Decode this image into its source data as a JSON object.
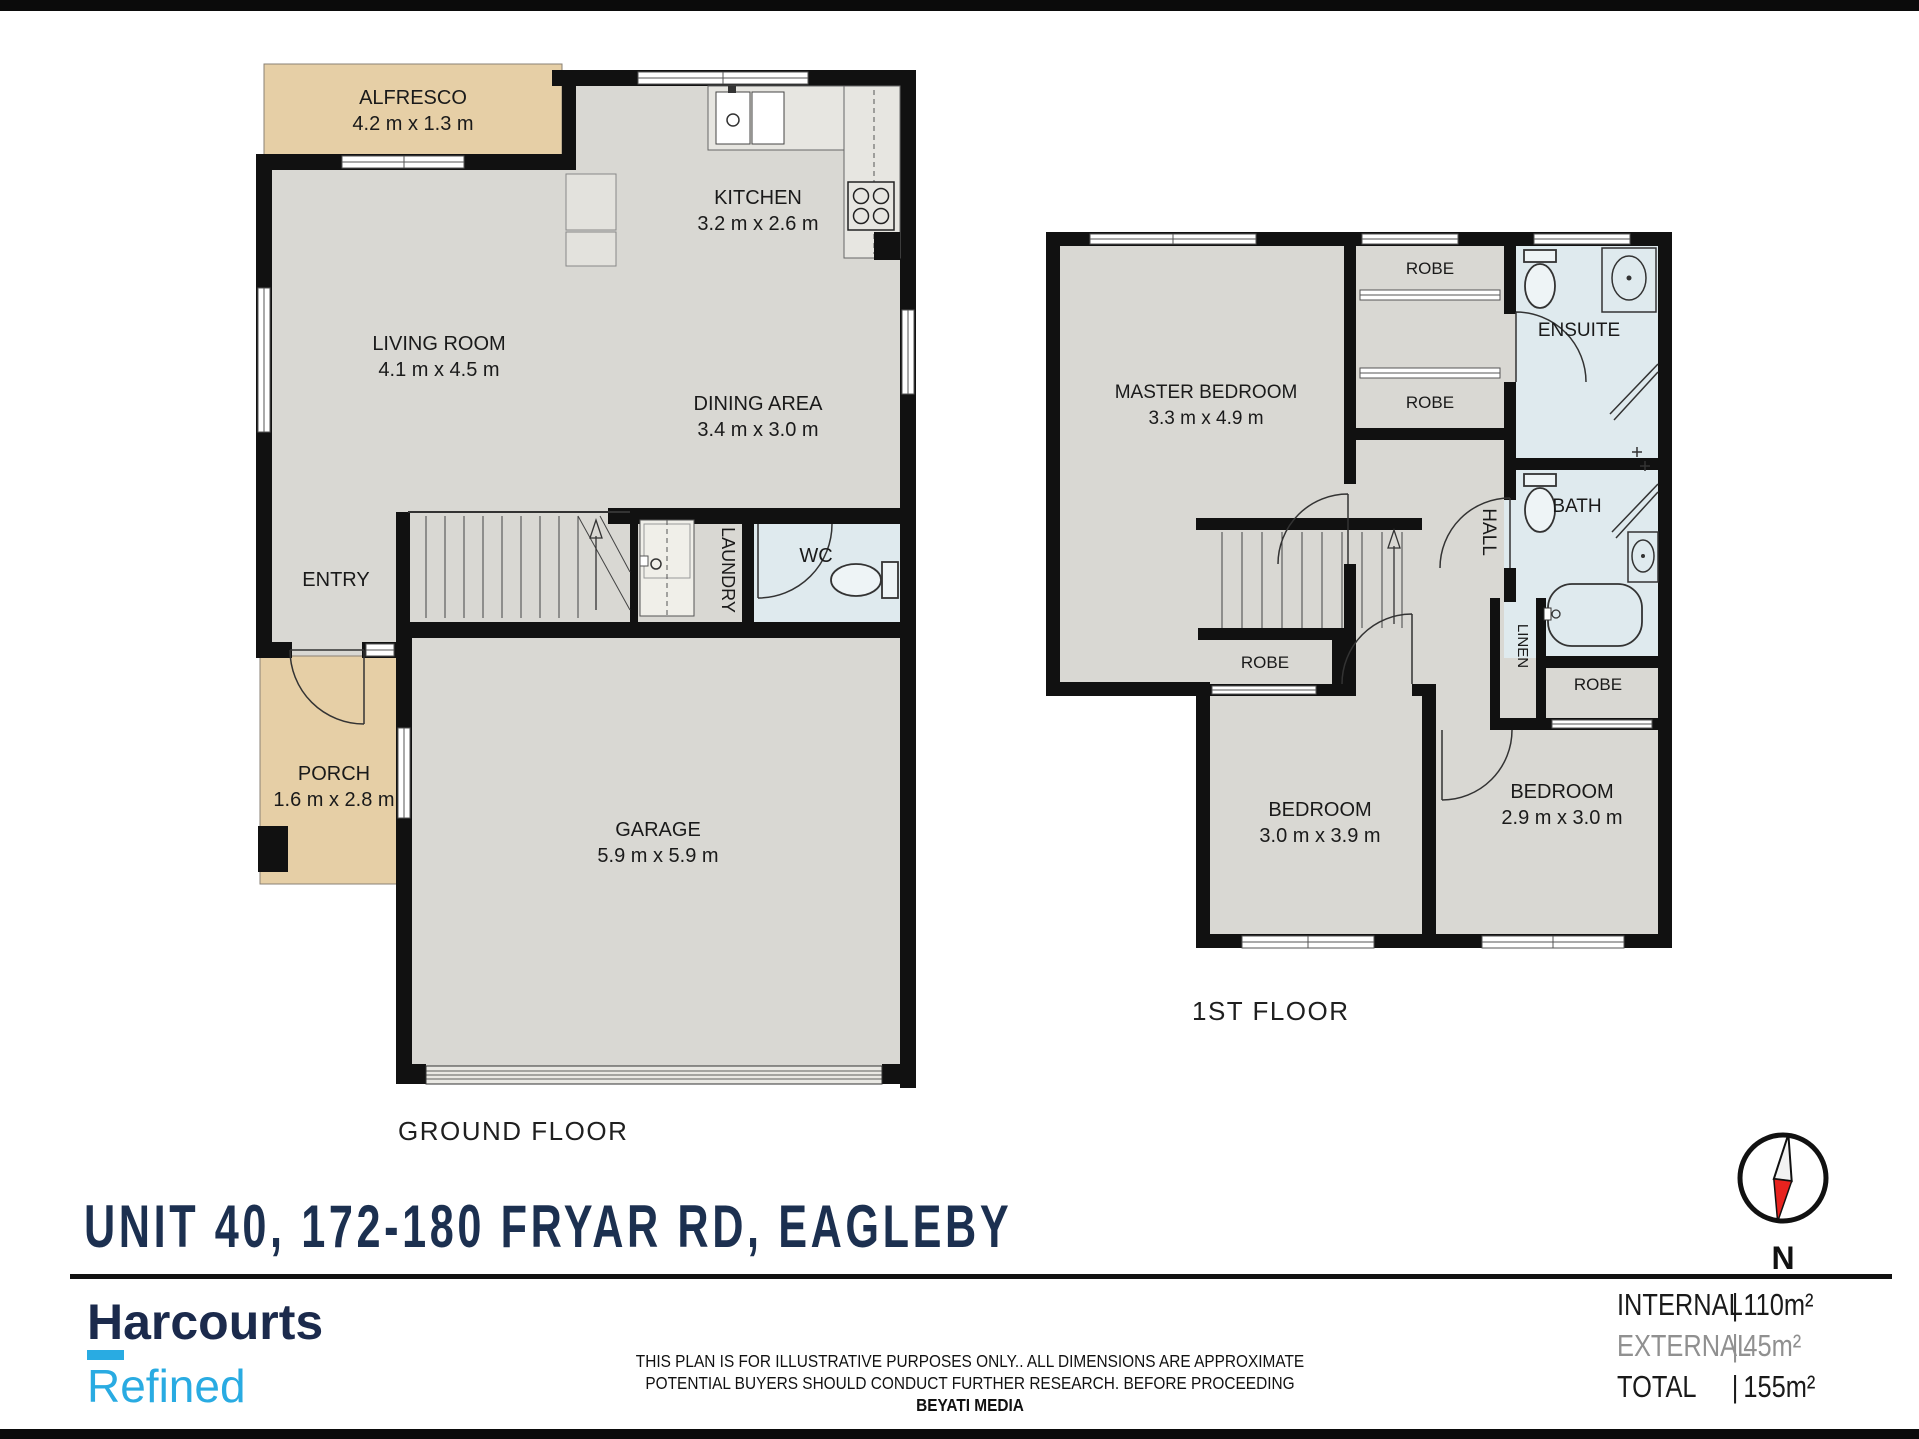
{
  "title": "UNIT 40, 172-180 FRYAR RD, EAGLEBY",
  "ground_floor": {
    "floor_label": "GROUND FLOOR",
    "alfresco_name": "ALFRESCO",
    "alfresco_dims": "4.2 m x 1.3 m",
    "kitchen_name": "KITCHEN",
    "kitchen_dims": "3.2 m x 2.6 m",
    "living_name": "LIVING ROOM",
    "living_dims": "4.1 m x 4.5 m",
    "dining_name": "DINING AREA",
    "dining_dims": "3.4 m x 3.0 m",
    "entry_name": "ENTRY",
    "laundry_name": "LAUNDRY",
    "wc_name": "WC",
    "porch_name": "PORCH",
    "porch_dims": "1.6 m x 2.8 m",
    "garage_name": "GARAGE",
    "garage_dims": "5.9 m x 5.9 m"
  },
  "first_floor": {
    "floor_label": "1ST FLOOR",
    "master_name": "MASTER BEDROOM",
    "master_dims": "3.3 m x 4.9 m",
    "robe1": "ROBE",
    "robe2": "ROBE",
    "robe3": "ROBE",
    "robe4": "ROBE",
    "ensuite_name": "ENSUITE",
    "bath_name": "BATH",
    "hall_name": "HALL",
    "linen_name": "LINEN",
    "bedroom1_name": "BEDROOM",
    "bedroom1_dims": "3.0 m x 3.9 m",
    "bedroom2_name": "BEDROOM",
    "bedroom2_dims": "2.9 m x 3.0 m"
  },
  "branding": {
    "name": "Harcourts",
    "division": "Refined"
  },
  "compass": {
    "label": "N"
  },
  "disclaimer": {
    "line1": "THIS PLAN IS FOR ILLUSTRATIVE PURPOSES ONLY.. ALL DIMENSIONS ARE APPROXIMATE",
    "line2": "POTENTIAL BUYERS SHOULD CONDUCT  FURTHER RESEARCH. BEFORE PROCEEDING",
    "line3": "BEYATI MEDIA"
  },
  "areas": {
    "rows": [
      {
        "label": "INTERNAL",
        "value": "110m²"
      },
      {
        "label": "EXTERNAL",
        "value": "45m²"
      },
      {
        "label": "TOTAL",
        "value": "155m²"
      }
    ]
  },
  "colors": {
    "wall": "#111111",
    "floor": "#d9d8d3",
    "outdoor": "#e6cfa6",
    "wet_room": "#dfeaee",
    "title_navy": "#1c3050",
    "brand_blue": "#29abe2",
    "needle_red": "#e8231f"
  }
}
